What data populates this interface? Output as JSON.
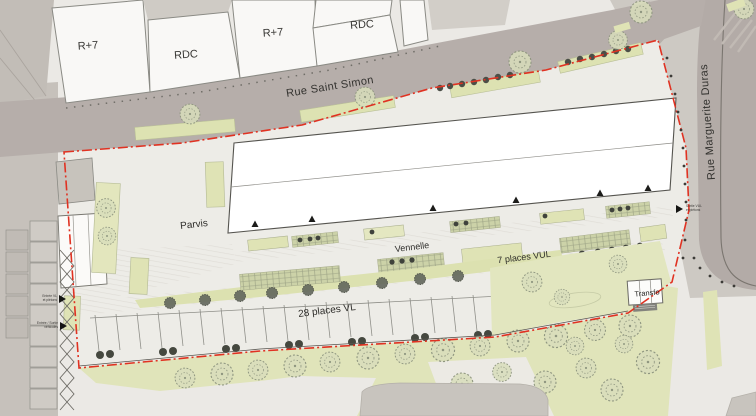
{
  "plan": {
    "streets": {
      "saint_simon": "Rue Saint Simon",
      "marguerite_duras": "Rue Marguerite Duras"
    },
    "existing_buildings": {
      "b1": "R+7",
      "b2": "RDC",
      "b3": "R+7",
      "b4": "RDC"
    },
    "site_labels": {
      "parvis": "Parvis",
      "vennelle": "Vennelle",
      "transfo": "Transfo"
    },
    "parking": {
      "vul": "7 places VUL",
      "vl": "28 places VL"
    },
    "access_notes": {
      "left_top_line1": "Entrée VL",
      "left_top_line2": "et piétons",
      "left_bottom_line1": "Entrée / Sortie",
      "left_bottom_line2": "véhicules",
      "right_line1": "Sortie VUL",
      "right_line2": "et piétons"
    },
    "colors": {
      "boundary": "#e03222",
      "street": "#b6aeaa",
      "green": "#e0e4ba",
      "new_building": "#ffffff"
    }
  }
}
